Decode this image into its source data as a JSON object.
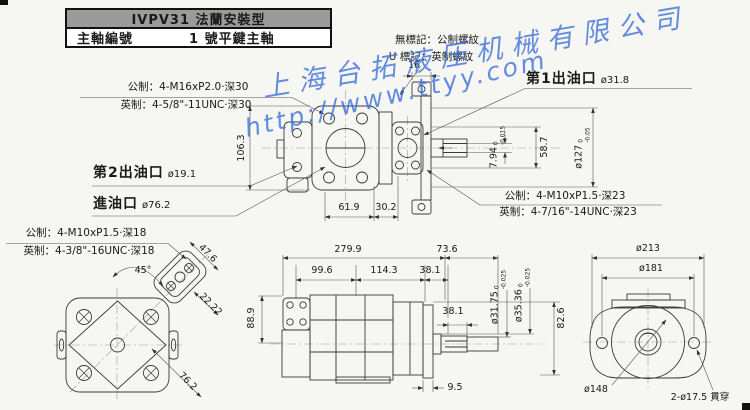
{
  "title_block": {
    "header": "IVPV31 法蘭安裝型",
    "row_label": "主軸編號",
    "row_value": "1 號平鍵主軸"
  },
  "watermark": {
    "company": "上海台拓液压机械有限公司",
    "url": "http://www.ttyy.com",
    "color": "#3a6ed8"
  },
  "notes": {
    "thread_no_mark": "無標記：公制螺紋",
    "thread_u_mark": "U 標記：英制螺紋"
  },
  "callouts": {
    "outlet1_label": "第1出油口",
    "outlet1_size": "ø31.8",
    "outlet2_label": "第2出油口",
    "outlet2_size": "ø19.1",
    "inlet_label": "進油口",
    "inlet_size": "ø76.2",
    "top_left_metric": "公制：4-M16xP2.0·深30",
    "top_left_imperial": "英制：4-5/8\"-11UNC·深30",
    "right_metric": "公制：4-M10xP1.5·深23",
    "right_imperial": "英制：4-7/16\"-14UNC·深23",
    "bottom_left_metric": "公制：4-M10xP1.5·深18",
    "bottom_left_imperial": "英制：4-3/8\"-16UNC·深18"
  },
  "dims": {
    "flange_tab": "16",
    "body_height": "106.3",
    "w61_9": "61.9",
    "w30_2": "30.2",
    "key_height": "7.94",
    "key_tol_hi": "0",
    "key_tol_lo": "-0.015",
    "shaft_len": "58.7",
    "pilot_dia": "ø127",
    "pilot_tol_hi": "0",
    "pilot_tol_lo": "-0.05",
    "angle_45": "45°",
    "d47_6": "47.6",
    "d22_22": "22.22",
    "d76_2": "76.2",
    "d88_9": "88.9",
    "len_total": "279.9",
    "shaft_ext": "73.6",
    "d99_6": "99.6",
    "d114_3": "114.3",
    "d38_1a": "38.1",
    "d38_1b": "38.1",
    "d9_5": "9.5",
    "d82_6": "82.6",
    "shaft_dia1": "ø31.75",
    "shaft_dia1_tol_hi": "0",
    "shaft_dia1_tol_lo": "-0.025",
    "shaft_dia2": "ø35.36",
    "shaft_dia2_tol_hi": "0",
    "shaft_dia2_tol_lo": "-0.025",
    "dia213": "ø213",
    "dia181": "ø181",
    "dia148": "ø148",
    "mount_holes": "2-ø17.5 貫穿"
  }
}
